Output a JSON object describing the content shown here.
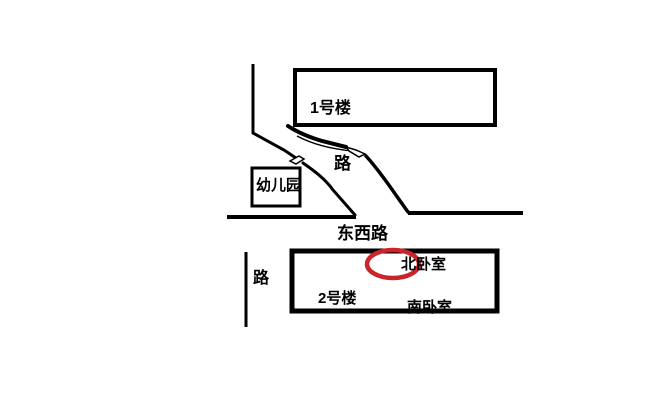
{
  "canvas": {
    "background": "#ffffff",
    "ink_color": "#000000",
    "highlight_color": "#c9252b"
  },
  "labels": {
    "building1": "1号楼",
    "upper_road": "路",
    "kindergarten": "幼儿园",
    "east_west_road": "东西路",
    "left_road": "路",
    "building2": "2号楼",
    "north_bedroom": "北卧室",
    "south_bedroom": "南卧室"
  }
}
